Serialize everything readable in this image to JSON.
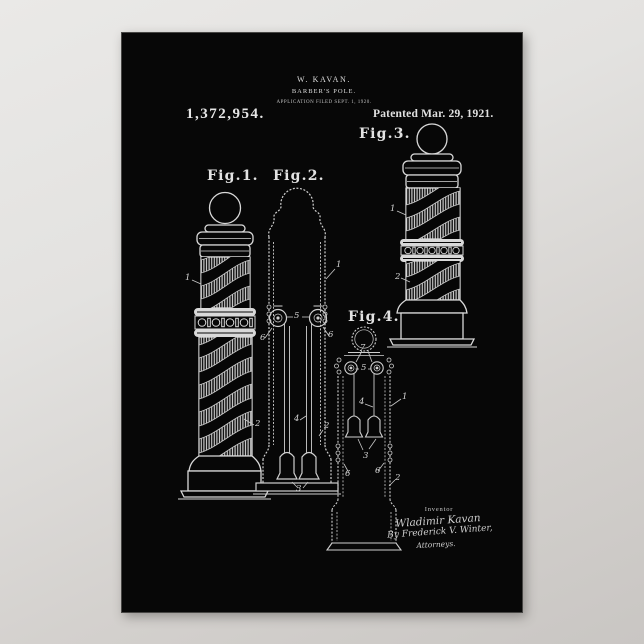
{
  "background": {
    "top_color": "#eae9e7",
    "bottom_color": "#c9c6c3"
  },
  "poster": {
    "bg_color": "#070707",
    "ink_color": "#dcdcdc",
    "header": {
      "inventor": "W. KAVAN.",
      "title": "BARBER'S POLE.",
      "application": "APPLICATION FILED SEPT. 1, 1920.",
      "patent_number": "1,372,954.",
      "patented": "Patented Mar. 29, 1921."
    },
    "figures": {
      "fig1": {
        "label": "Fig.1.",
        "refs": [
          "1",
          "2"
        ]
      },
      "fig2": {
        "label": "Fig.2.",
        "refs": [
          "1",
          "5",
          "6",
          "6",
          "4",
          "2",
          "3"
        ]
      },
      "fig3": {
        "label": "Fig.3.",
        "refs": [
          "1",
          "2"
        ]
      },
      "fig4": {
        "label": "Fig.4.",
        "refs": [
          "7",
          "5",
          "4",
          "3",
          "1",
          "2",
          "6",
          "6"
        ]
      }
    },
    "signature": {
      "caption": "Inventor",
      "inventor_name": "Wladimir Kavan",
      "by_line": "By Frederick V. Winter,",
      "attorneys": "Attorneys."
    }
  }
}
